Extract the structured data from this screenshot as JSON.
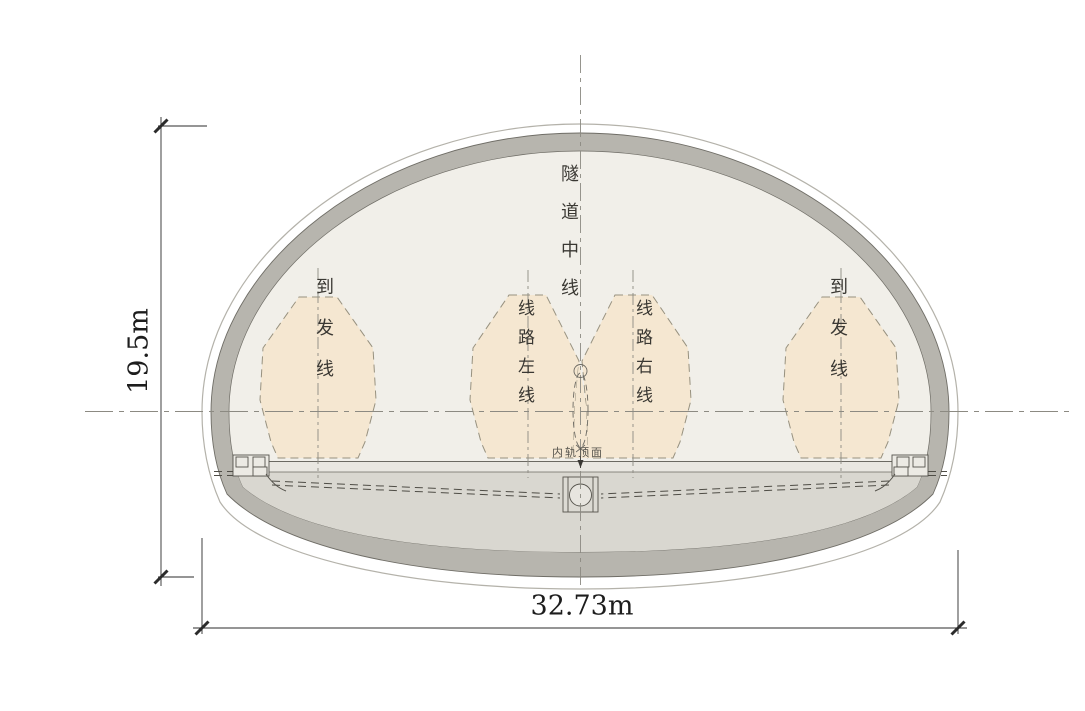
{
  "drawing": {
    "type": "tunnel-cross-section-diagram",
    "labels": {
      "tunnel_centerline": "隧道中线",
      "siding_left": "到发线",
      "main_line_left": "线路左线",
      "main_line_right": "线路右线",
      "siding_right": "到发线",
      "rail_top_surface": "内轨顶面"
    },
    "dimensions": {
      "height": "19.5m",
      "width": "32.73m"
    },
    "colors": {
      "envelope_fill": "#f5e7d1",
      "envelope_stroke": "#97917f",
      "lining_fill": "#b7b5ae",
      "inner_fill": "#f1efe9",
      "invert_fill": "#d9d7d0",
      "slab_fill": "#e9e7e1",
      "outline_stroke": "#6f6d66",
      "outer_line": "#b4b2aa",
      "centerline": "#8c8a82",
      "detail_stroke": "#4f4d46",
      "dim_stroke": "#2b2b2b"
    }
  }
}
